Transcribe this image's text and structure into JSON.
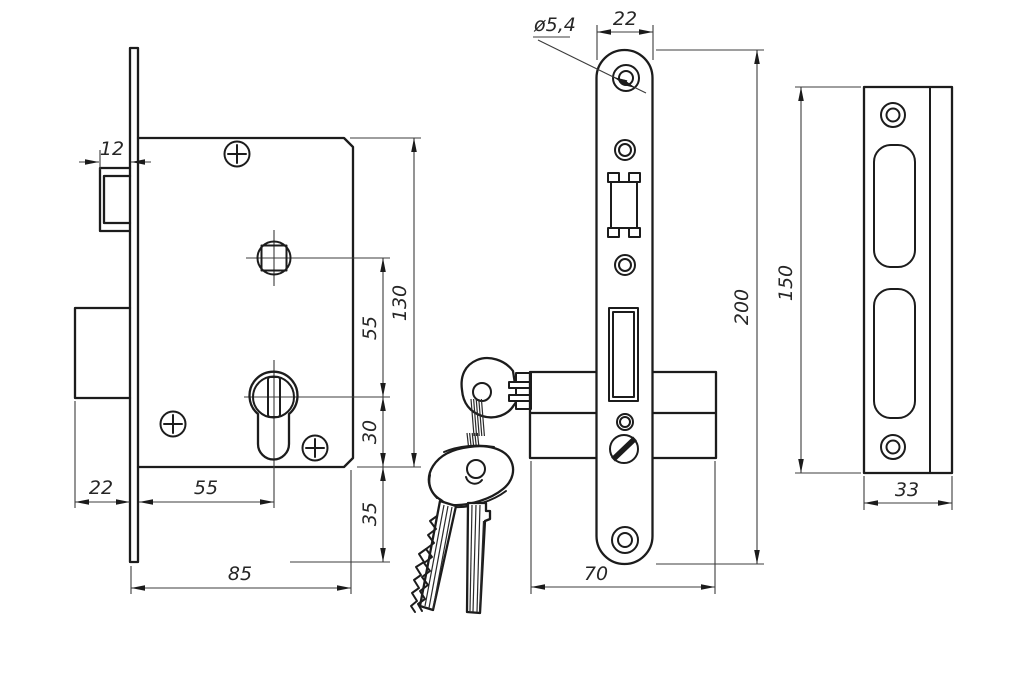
{
  "drawing": {
    "colors": {
      "ink": "#1c1c1c",
      "thin_line": "#3c3c3c",
      "background": "#ffffff"
    },
    "views": {
      "lock_side_view": {
        "dims": {
          "latch_depth": "12",
          "deadbolt_throw": "22",
          "faceplate_to_cylinder_center": "55",
          "case_width": "85",
          "spindle_to_cylinder": "55",
          "case_height": "130",
          "cylinder_to_case_bottom": "30",
          "case_bottom_to_faceplate_end": "35"
        }
      },
      "lock_front_view": {
        "dims": {
          "screw_hole_diameter": "ø5,4",
          "faceplate_width": "22",
          "faceplate_length": "200",
          "case_width": "70"
        }
      },
      "strike_plate_view": {
        "dims": {
          "plate_length": "150",
          "plate_width": "33"
        }
      }
    }
  }
}
